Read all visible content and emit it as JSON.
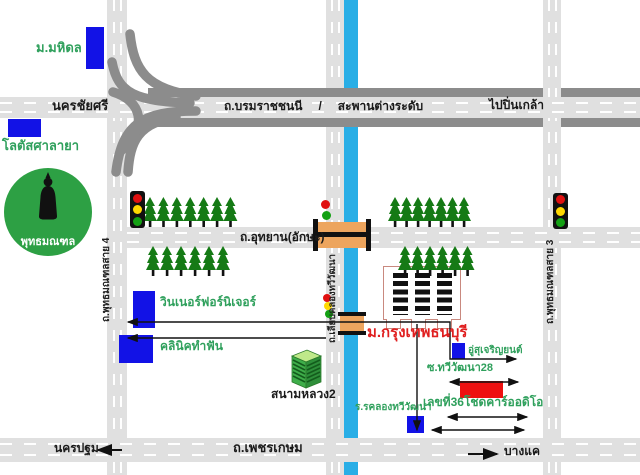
{
  "map": {
    "places": {
      "mahidol": "ม.มหิดล",
      "lotus_salaya": "โลตัสศาลายา",
      "phutthamonthon": "พุทธมณฑล",
      "winner_furniture": "วินเนอร์ฟอร์นิเจอร์",
      "dental_clinic": "คลินิคทำฟัน",
      "sanam_luang2": "สนามหลวง2",
      "bangkok_thonburi_university": "ม.กรุงเทพธนบุรี",
      "garage": "อู่สุเจริญยนต์",
      "soi_thawi_watthana_28": "ซ.ทวีวัฒนา28",
      "chod_car_audio_address": "เลขที่36โชดคาร์ออดิโอ",
      "khlong_thawi_watthana_school": "ร.รคลองทวีวัฒนา"
    },
    "roads": {
      "nakhon_chai_si": "นครชัยศรี",
      "borommaratchachonnani": "ถ.บรมราชชนนี",
      "slash": "/",
      "flyover": "สะพานต่างระดับ",
      "to_pin_klao": "ไปปิ่นเกล้า",
      "utthayan_aksa": "ถ.อุทยาน(อักษะ)",
      "phutthamonthon_sai4": "ถ.พุทธมณฑลสาย 4",
      "phutthamonthon_sai3": "ถ.พุทธมณฑลสาย 3",
      "liap_khlong_thawi_watthana": "ถ.เลียบคลองทวีวัฒนา",
      "phetkasem": "ถ.เพชรเกษม",
      "to_nakhon_pathom": "นครปฐม",
      "to_bang_khae": "บางแค"
    },
    "colors": {
      "road_fill": "#e0e0e0",
      "road_edge": "#8c8c8c",
      "canal": "#29aee6",
      "building_blue": "#1212e6",
      "building_red": "#ee1010",
      "tree": "#157a15",
      "monument_green": "#2da044",
      "label_green": "#2fa05c",
      "label_red": "#e02020",
      "bridge_orange": "#eda55e"
    },
    "geometry": {
      "ramps": [
        "M130,34 C134,70 146,89 196,96",
        "M112,62 C118,94 136,101 190,103",
        "M196,111 C142,111 122,124 116,172",
        "M176,117 C138,123 130,142 128,172",
        "M113,92 C142,101 148,126 122,150"
      ],
      "route_lines": [
        {
          "d": "M128,322 H450 V359 H516",
          "ms": true,
          "me": true,
          "w": 1.4
        },
        {
          "d": "M128,338 H326",
          "ms": true,
          "me": false,
          "w": 1.4
        },
        {
          "d": "M450,382 H518",
          "ms": true,
          "me": true,
          "w": 1.4
        },
        {
          "d": "M448,417 H527",
          "ms": true,
          "me": true,
          "w": 1.4
        },
        {
          "d": "M432,430 H524",
          "ms": true,
          "me": true,
          "w": 1.4
        },
        {
          "d": "M417,324 V430",
          "ms": false,
          "me": true,
          "w": 1.4
        },
        {
          "d": "M122,450 H98",
          "ms": false,
          "me": true,
          "w": 2
        },
        {
          "d": "M468,454 H497",
          "ms": false,
          "me": true,
          "w": 2
        }
      ],
      "tree_groups": [
        {
          "x": 143,
          "y": 197,
          "count": 7,
          "gap": 13.4
        },
        {
          "x": 146,
          "y": 246,
          "count": 6,
          "gap": 14
        },
        {
          "x": 388,
          "y": 197,
          "count": 7,
          "gap": 11.5
        },
        {
          "x": 398,
          "y": 246,
          "count": 6,
          "gap": 12.5
        }
      ]
    }
  }
}
